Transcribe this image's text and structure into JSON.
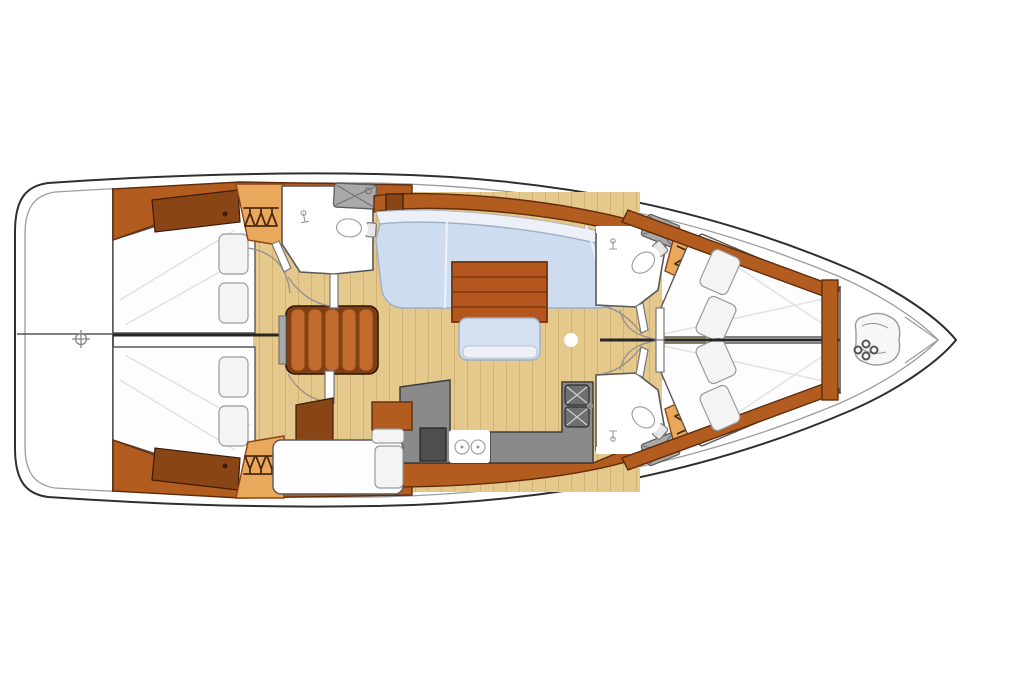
{
  "figure": {
    "kind": "sailing-yacht-interior-floorplan",
    "orientation": "bow-right",
    "cabins": "2 aft double cabins, 2 forward double cabins",
    "heads": "3 (1 aft, 2 forward)",
    "pillows_per_cabin": 2
  },
  "colors": {
    "hull_stroke": "#2f2f2f",
    "deck_stroke": "#9c9c9c",
    "wood": "#b25c20",
    "wood_dark": "#5f2d0c",
    "wood_mid": "#8a4516",
    "wood_panel": "#8a4516",
    "wood_light": "#eaa85c",
    "floor": "#e5c88c",
    "floor_line": "#d3b273",
    "settee": "#cddcef",
    "settee_line": "#9db0c8",
    "settee_back": "#edf1f7",
    "table": "#b4571e",
    "table_line": "#8e3f11",
    "counter": "#8a8a8a",
    "counter_stroke": "#3d3d3d",
    "appliance": "#4e4e4e",
    "sink_steel": "#6f6f6f",
    "room_stroke": "#585858",
    "pillow": "#f4f4f4",
    "pillow_stroke": "#9a9a9a",
    "berth": "#fdfdfd",
    "shade": "#e2e2e2",
    "wall": "#262626",
    "grate": "#a9a9a9",
    "grate_stroke": "#5e5e5e",
    "arc": "#8f8f8f",
    "icon_dark": "#4a2a10",
    "chain": "#555555",
    "stair": "#c36a2e",
    "stair_base": "#7e3e12"
  },
  "icons": {
    "helm": "helm-position-icon",
    "hanger": "clothes-hanger-icon",
    "anchor_chain": "anchor-chain-icon",
    "faucet": "faucet-icon",
    "shower_grate": "shower-grate-icon",
    "stove_burner": "stove-burner-icon",
    "mast_post": "mast-post-icon"
  }
}
